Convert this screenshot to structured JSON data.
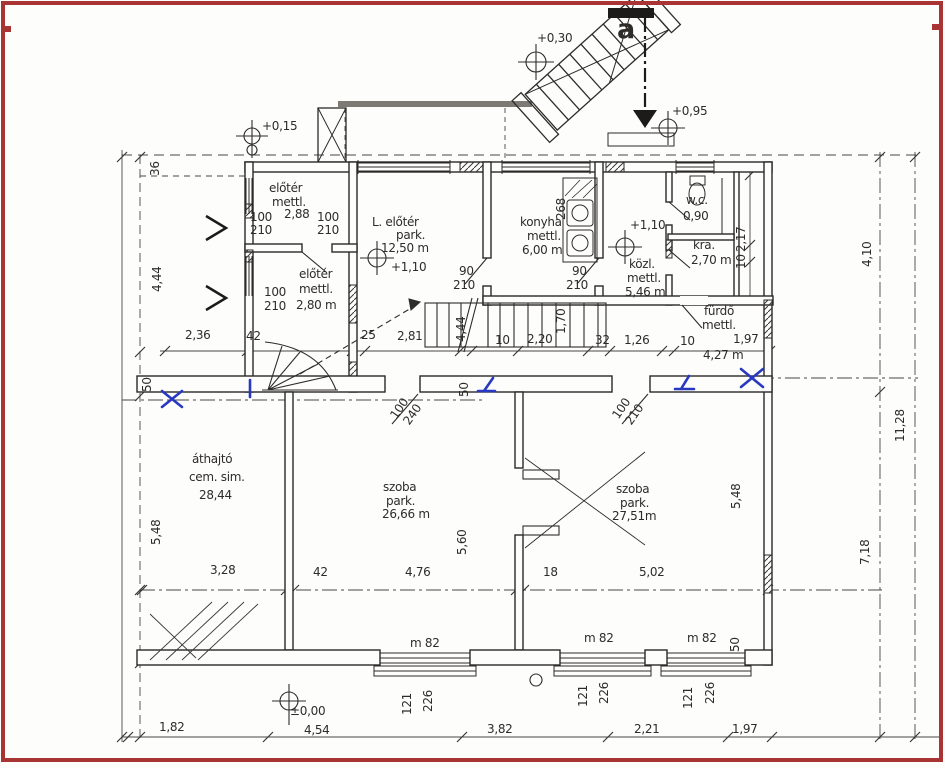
{
  "document": {
    "kind": "scanned architectural floor plan",
    "language": "Hungarian",
    "frame_color": "#a83434",
    "paper_color": "#fdfdfb",
    "ink_color": "#2e2c28",
    "ink_blue": "#2838c0"
  },
  "rooms": [
    {
      "name": "előtér",
      "finish": "mettl.",
      "area": "2,88"
    },
    {
      "name": "előtér",
      "finish": "mettl.",
      "area": "2,80 m"
    },
    {
      "name": "L. előtér",
      "finish": "park.",
      "area": "12,50 m"
    },
    {
      "name": "konyha",
      "finish": "mettl.",
      "area": "6,00 m"
    },
    {
      "name": "w.c.",
      "area": "0,90"
    },
    {
      "name": "kra.",
      "area": "2,70 m"
    },
    {
      "name": "közl.",
      "finish": "mettl.",
      "area": "5,46 m"
    },
    {
      "name": "fürdő",
      "finish": "mettl.",
      "area": "4,27 m"
    },
    {
      "name": "áthajtó",
      "finish": "cem. sim.",
      "area": "28,44"
    },
    {
      "name": "szoba",
      "finish": "park.",
      "area": "26,66 m"
    },
    {
      "name": "szoba",
      "finish": "park.",
      "area": "27,51m"
    }
  ],
  "levels": [
    "+0,15",
    "+0,30",
    "+0,95",
    "+1,10",
    "+1,10",
    "±0,00"
  ],
  "labels": [
    {
      "t": "+0,15",
      "x": 262,
      "y": 120,
      "n": "level-annotation"
    },
    {
      "t": "36",
      "x": 149,
      "y": 176,
      "r": -90,
      "n": "dimension"
    },
    {
      "t": "+0,30",
      "x": 537,
      "y": 32,
      "n": "level-annotation"
    },
    {
      "t": "a",
      "x": 617,
      "y": 16,
      "s": 27,
      "b": 1,
      "n": "section-marker"
    },
    {
      "t": "+0,95",
      "x": 672,
      "y": 105,
      "n": "level-annotation"
    },
    {
      "t": "előtér",
      "x": 269,
      "y": 182,
      "n": "room-label"
    },
    {
      "t": "mettl.",
      "x": 272,
      "y": 196,
      "n": "room-label"
    },
    {
      "t": "100",
      "x": 250,
      "y": 211,
      "n": "door-size"
    },
    {
      "t": "2,88",
      "x": 284,
      "y": 208,
      "n": "room-label"
    },
    {
      "t": "100",
      "x": 317,
      "y": 211,
      "n": "door-size"
    },
    {
      "t": "210",
      "x": 250,
      "y": 224,
      "n": "door-size"
    },
    {
      "t": "210",
      "x": 317,
      "y": 224,
      "n": "door-size"
    },
    {
      "t": "L. előtér",
      "x": 372,
      "y": 216,
      "n": "room-label"
    },
    {
      "t": "park.",
      "x": 396,
      "y": 229,
      "n": "room-label"
    },
    {
      "t": "12,50 m",
      "x": 381,
      "y": 242,
      "n": "room-label"
    },
    {
      "t": "+1,10",
      "x": 391,
      "y": 261,
      "n": "level-annotation"
    },
    {
      "t": "előtér",
      "x": 299,
      "y": 268,
      "n": "room-label"
    },
    {
      "t": "100",
      "x": 264,
      "y": 286,
      "n": "door-size"
    },
    {
      "t": "mettl.",
      "x": 299,
      "y": 283,
      "n": "room-label"
    },
    {
      "t": "210",
      "x": 264,
      "y": 300,
      "n": "door-size"
    },
    {
      "t": "2,80 m",
      "x": 296,
      "y": 299,
      "n": "room-label"
    },
    {
      "t": "konyha",
      "x": 520,
      "y": 216,
      "n": "room-label"
    },
    {
      "t": "mettl.",
      "x": 527,
      "y": 230,
      "n": "room-label"
    },
    {
      "t": "6,00 m",
      "x": 522,
      "y": 244,
      "n": "room-label"
    },
    {
      "t": "268",
      "x": 555,
      "y": 220,
      "r": -90,
      "n": "dimension"
    },
    {
      "t": "90",
      "x": 459,
      "y": 265,
      "n": "door-size"
    },
    {
      "t": "210",
      "x": 453,
      "y": 279,
      "n": "door-size"
    },
    {
      "t": "90",
      "x": 572,
      "y": 265,
      "n": "door-size"
    },
    {
      "t": "210",
      "x": 566,
      "y": 279,
      "n": "door-size"
    },
    {
      "t": "+1,10",
      "x": 630,
      "y": 219,
      "n": "level-annotation"
    },
    {
      "t": "w.c.",
      "x": 686,
      "y": 194,
      "n": "room-label"
    },
    {
      "t": "0,90",
      "x": 683,
      "y": 210,
      "n": "room-label"
    },
    {
      "t": "kra.",
      "x": 693,
      "y": 239,
      "n": "room-label"
    },
    {
      "t": "2,70 m",
      "x": 691,
      "y": 254,
      "n": "room-label"
    },
    {
      "t": "közl.",
      "x": 629,
      "y": 258,
      "n": "room-label"
    },
    {
      "t": "mettl.",
      "x": 627,
      "y": 272,
      "n": "room-label"
    },
    {
      "t": "5,46 m",
      "x": 625,
      "y": 286,
      "n": "room-label"
    },
    {
      "t": "2,17",
      "x": 735,
      "y": 252,
      "r": -90,
      "n": "dimension"
    },
    {
      "t": "10",
      "x": 735,
      "y": 269,
      "r": -90,
      "n": "dimension"
    },
    {
      "t": "fürdő",
      "x": 704,
      "y": 305,
      "n": "room-label"
    },
    {
      "t": "mettl.",
      "x": 702,
      "y": 319,
      "n": "room-label"
    },
    {
      "t": "10",
      "x": 680,
      "y": 335,
      "n": "dimension"
    },
    {
      "t": "1,97",
      "x": 733,
      "y": 333,
      "n": "dimension"
    },
    {
      "t": "4,27 m",
      "x": 703,
      "y": 349,
      "n": "room-label"
    },
    {
      "t": "4,44",
      "x": 151,
      "y": 292,
      "r": -90,
      "n": "dimension"
    },
    {
      "t": "2,36",
      "x": 185,
      "y": 329,
      "n": "dimension"
    },
    {
      "t": "42",
      "x": 246,
      "y": 330,
      "n": "dimension"
    },
    {
      "t": "25",
      "x": 361,
      "y": 329,
      "n": "dimension"
    },
    {
      "t": "2,81",
      "x": 397,
      "y": 330,
      "n": "dimension"
    },
    {
      "t": "4,44",
      "x": 455,
      "y": 342,
      "r": -90,
      "n": "dimension"
    },
    {
      "t": "1,70",
      "x": 555,
      "y": 334,
      "r": -90,
      "n": "dimension"
    },
    {
      "t": "10",
      "x": 495,
      "y": 334,
      "n": "dimension"
    },
    {
      "t": "2,20",
      "x": 527,
      "y": 333,
      "n": "dimension"
    },
    {
      "t": "32",
      "x": 595,
      "y": 334,
      "n": "dimension"
    },
    {
      "t": "1,26",
      "x": 624,
      "y": 334,
      "n": "dimension"
    },
    {
      "t": "50",
      "x": 141,
      "y": 392,
      "r": -90,
      "n": "dimension"
    },
    {
      "t": "50",
      "x": 458,
      "y": 397,
      "r": -90,
      "n": "dimension"
    },
    {
      "t": "100",
      "x": 388,
      "y": 414,
      "r": -55,
      "n": "door-size"
    },
    {
      "t": "240",
      "x": 401,
      "y": 420,
      "r": -55,
      "n": "door-size"
    },
    {
      "t": "100",
      "x": 610,
      "y": 414,
      "r": -55,
      "n": "door-size"
    },
    {
      "t": "210",
      "x": 623,
      "y": 420,
      "r": -55,
      "n": "door-size"
    },
    {
      "t": "áthajtó",
      "x": 192,
      "y": 453,
      "n": "room-label"
    },
    {
      "t": "cem. sim.",
      "x": 189,
      "y": 471,
      "n": "room-label"
    },
    {
      "t": "28,44",
      "x": 199,
      "y": 489,
      "n": "room-label"
    },
    {
      "t": "szoba",
      "x": 383,
      "y": 481,
      "n": "room-label"
    },
    {
      "t": "park.",
      "x": 386,
      "y": 495,
      "n": "room-label"
    },
    {
      "t": "26,66 m",
      "x": 382,
      "y": 508,
      "n": "room-label"
    },
    {
      "t": "szoba",
      "x": 616,
      "y": 483,
      "n": "room-label"
    },
    {
      "t": "park.",
      "x": 620,
      "y": 497,
      "n": "room-label"
    },
    {
      "t": "27,51m",
      "x": 612,
      "y": 510,
      "n": "room-label"
    },
    {
      "t": "5,48",
      "x": 150,
      "y": 545,
      "r": -90,
      "n": "dimension"
    },
    {
      "t": "5,60",
      "x": 456,
      "y": 555,
      "r": -90,
      "n": "dimension"
    },
    {
      "t": "5,48",
      "x": 730,
      "y": 509,
      "r": -90,
      "n": "dimension"
    },
    {
      "t": "4,10",
      "x": 861,
      "y": 267,
      "r": -90,
      "n": "dimension"
    },
    {
      "t": "11,28",
      "x": 894,
      "y": 442,
      "r": -90,
      "n": "dimension"
    },
    {
      "t": "7,18",
      "x": 859,
      "y": 565,
      "r": -90,
      "n": "dimension"
    },
    {
      "t": "3,28",
      "x": 210,
      "y": 564,
      "n": "dimension"
    },
    {
      "t": "42",
      "x": 313,
      "y": 566,
      "n": "dimension"
    },
    {
      "t": "4,76",
      "x": 405,
      "y": 566,
      "n": "dimension"
    },
    {
      "t": "18",
      "x": 543,
      "y": 566,
      "n": "dimension"
    },
    {
      "t": "5,02",
      "x": 639,
      "y": 566,
      "n": "dimension"
    },
    {
      "t": "m 82",
      "x": 410,
      "y": 637,
      "n": "window-size"
    },
    {
      "t": "m 82",
      "x": 584,
      "y": 632,
      "n": "window-size"
    },
    {
      "t": "m 82",
      "x": 687,
      "y": 632,
      "n": "window-size"
    },
    {
      "t": "50",
      "x": 729,
      "y": 652,
      "r": -90,
      "n": "dimension"
    },
    {
      "t": "121",
      "x": 401,
      "y": 715,
      "r": -90,
      "n": "window-size"
    },
    {
      "t": "226",
      "x": 422,
      "y": 712,
      "r": -90,
      "n": "window-size"
    },
    {
      "t": "121",
      "x": 577,
      "y": 707,
      "r": -90,
      "n": "window-size"
    },
    {
      "t": "226",
      "x": 598,
      "y": 704,
      "r": -90,
      "n": "window-size"
    },
    {
      "t": "121",
      "x": 682,
      "y": 709,
      "r": -90,
      "n": "window-size"
    },
    {
      "t": "226",
      "x": 704,
      "y": 704,
      "r": -90,
      "n": "window-size"
    },
    {
      "t": "±0,00",
      "x": 290,
      "y": 705,
      "n": "level-annotation"
    },
    {
      "t": "1,82",
      "x": 159,
      "y": 721,
      "n": "dimension"
    },
    {
      "t": "4,54",
      "x": 304,
      "y": 724,
      "n": "dimension"
    },
    {
      "t": "3,82",
      "x": 487,
      "y": 723,
      "n": "dimension"
    },
    {
      "t": "2,21",
      "x": 634,
      "y": 723,
      "n": "dimension"
    },
    {
      "t": "1,97",
      "x": 732,
      "y": 723,
      "n": "dimension"
    }
  ],
  "blue_marks": [
    {
      "kind": "x-mark",
      "d": "M162,391 L182,407 M182,391 L162,407"
    },
    {
      "kind": "x-mark",
      "d": "M741,369 L763,387 M763,369 L741,387"
    },
    {
      "kind": "tick",
      "d": "M250,380 L250,397"
    },
    {
      "kind": "arrow",
      "d": "M493,378 L484,391 M478,391 L495,391"
    },
    {
      "kind": "arrow",
      "d": "M689,376 L681,389 M675,389 L694,389"
    }
  ]
}
